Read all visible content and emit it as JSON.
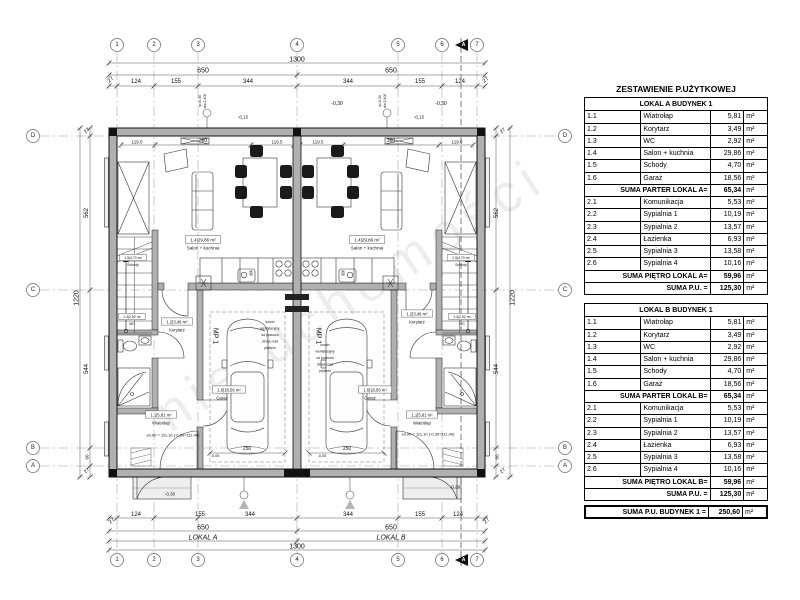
{
  "title": "ZESTAWIENIE P.UŻYTKOWEJ",
  "unit": "m²",
  "watermark": "nieruchomości",
  "tables": [
    {
      "header": "LOKAL A BUDYNEK 1",
      "rows": [
        {
          "no": "1.1",
          "name": "Wiatrołap",
          "value": "5,81"
        },
        {
          "no": "1.2",
          "name": "Korytarz",
          "value": "3,49"
        },
        {
          "no": "1.3",
          "name": "WC",
          "value": "2,92"
        },
        {
          "no": "1.4",
          "name": "Salon + kuchnia",
          "value": "29,86"
        },
        {
          "no": "1.5",
          "name": "Schody",
          "value": "4,70"
        },
        {
          "no": "1.6",
          "name": "Garaż",
          "value": "18,56"
        },
        {
          "sum": "SUMA PARTER LOKAL A=",
          "value": "65,34"
        },
        {
          "no": "2.1",
          "name": "Komunikacja",
          "value": "5,53"
        },
        {
          "no": "2.2",
          "name": "Sypialnia 1",
          "value": "10,19"
        },
        {
          "no": "2.3",
          "name": "Sypialnia 2",
          "value": "13,57"
        },
        {
          "no": "2.4",
          "name": "Łazienka",
          "value": "6,93"
        },
        {
          "no": "2.5",
          "name": "Sypialnia 3",
          "value": "13,58"
        },
        {
          "no": "2.6",
          "name": "Sypialnia 4",
          "value": "10,16"
        },
        {
          "sum": "SUMA PIĘTRO LOKAL A=",
          "value": "59,96"
        },
        {
          "sum": "SUMA P.U. =",
          "value": "125,30"
        }
      ]
    },
    {
      "header": "LOKAL B BUDYNEK 1",
      "rows": [
        {
          "no": "1.1",
          "name": "Wiatrołap",
          "value": "5,81"
        },
        {
          "no": "1.2",
          "name": "Korytarz",
          "value": "3,49"
        },
        {
          "no": "1.3",
          "name": "WC",
          "value": "2,92"
        },
        {
          "no": "1.4",
          "name": "Salon + kuchnia",
          "value": "29,86"
        },
        {
          "no": "1.5",
          "name": "Schody",
          "value": "4,70"
        },
        {
          "no": "1.6",
          "name": "Garaż",
          "value": "18,56"
        },
        {
          "sum": "SUMA PARTER LOKAL B=",
          "value": "65,34"
        },
        {
          "no": "2.1",
          "name": "Komunikacja",
          "value": "5,53"
        },
        {
          "no": "2.2",
          "name": "Sypialnia 1",
          "value": "10,19"
        },
        {
          "no": "2.3",
          "name": "Sypialnia 2",
          "value": "13,57"
        },
        {
          "no": "2.4",
          "name": "Łazienka",
          "value": "6,93"
        },
        {
          "no": "2.5",
          "name": "Sypialnia 3",
          "value": "13,58"
        },
        {
          "no": "2.6",
          "name": "Sypialnia 4",
          "value": "10,16"
        },
        {
          "sum": "SUMA PIĘTRO LOKAL B=",
          "value": "59,96"
        },
        {
          "sum": "SUMA P.U. =",
          "value": "125,30"
        }
      ]
    }
  ],
  "grand_total": {
    "label": "SUMA P.U. BUDYNEK 1 =",
    "value": "250,60"
  },
  "plan": {
    "bubbles": [
      {
        "l": "1",
        "x": 117,
        "y": 45
      },
      {
        "l": "2",
        "x": 154,
        "y": 45
      },
      {
        "l": "3",
        "x": 198,
        "y": 45
      },
      {
        "l": "4",
        "x": 297,
        "y": 45
      },
      {
        "l": "5",
        "x": 398,
        "y": 45
      },
      {
        "l": "6",
        "x": 442,
        "y": 45
      },
      {
        "l": "7",
        "x": 477,
        "y": 45
      },
      {
        "l": "1",
        "x": 117,
        "y": 560
      },
      {
        "l": "2",
        "x": 154,
        "y": 560
      },
      {
        "l": "3",
        "x": 198,
        "y": 560
      },
      {
        "l": "4",
        "x": 297,
        "y": 560
      },
      {
        "l": "5",
        "x": 398,
        "y": 560
      },
      {
        "l": "6",
        "x": 442,
        "y": 560
      },
      {
        "l": "7",
        "x": 477,
        "y": 560
      },
      {
        "l": "D",
        "x": 33,
        "y": 136
      },
      {
        "l": "C",
        "x": 33,
        "y": 290
      },
      {
        "l": "B",
        "x": 33,
        "y": 448
      },
      {
        "l": "A",
        "x": 33,
        "y": 466
      },
      {
        "l": "D",
        "x": 565,
        "y": 136
      },
      {
        "l": "C",
        "x": 565,
        "y": 290
      },
      {
        "l": "B",
        "x": 565,
        "y": 448
      },
      {
        "l": "A",
        "x": 565,
        "y": 466
      }
    ],
    "section_markers": [
      {
        "l": "A",
        "x": 461,
        "y": 45
      },
      {
        "l": "A",
        "x": 461,
        "y": 560
      }
    ],
    "texts": [
      {
        "t": "1300",
        "x": 297,
        "y": 60,
        "s": 7
      },
      {
        "t": "650",
        "x": 203,
        "y": 71,
        "s": 7
      },
      {
        "t": "650",
        "x": 391,
        "y": 71,
        "s": 7
      },
      {
        "t": "27",
        "x": 111,
        "y": 80,
        "s": 5.5,
        "r": -45
      },
      {
        "t": "124",
        "x": 136,
        "y": 82,
        "s": 6
      },
      {
        "t": "155",
        "x": 176,
        "y": 82,
        "s": 6
      },
      {
        "t": "344",
        "x": 248,
        "y": 82,
        "s": 6
      },
      {
        "t": "344",
        "x": 348,
        "y": 82,
        "s": 6
      },
      {
        "t": "155",
        "x": 420,
        "y": 82,
        "s": 6
      },
      {
        "t": "124",
        "x": 460,
        "y": 82,
        "s": 6
      },
      {
        "t": "27",
        "x": 486,
        "y": 80,
        "s": 5.5,
        "r": -45
      },
      {
        "t": "-0,30",
        "x": 337,
        "y": 104,
        "s": 5
      },
      {
        "t": "-0,30",
        "x": 441,
        "y": 104,
        "s": 5
      },
      {
        "t": "-0,15",
        "x": 243,
        "y": 117,
        "s": 4.5
      },
      {
        "t": "-0,15",
        "x": 419,
        "y": 117,
        "s": 4.5
      },
      {
        "t": "rp=0,00",
        "x": 200,
        "y": 101,
        "s": 3.5,
        "r": -90
      },
      {
        "t": "dn=2,400",
        "x": 205,
        "y": 101,
        "s": 3.5,
        "r": -90
      },
      {
        "t": "rp=0,00",
        "x": 380,
        "y": 101,
        "s": 3.5,
        "r": -90
      },
      {
        "t": "dn=2,400",
        "x": 385,
        "y": 101,
        "s": 3.5,
        "r": -90
      },
      {
        "t": "119.5",
        "x": 137,
        "y": 142,
        "s": 4.5
      },
      {
        "t": "360",
        "x": 203,
        "y": 141,
        "s": 5
      },
      {
        "t": "119.5",
        "x": 277,
        "y": 142,
        "s": 4.5
      },
      {
        "t": "119.5",
        "x": 318,
        "y": 142,
        "s": 4.5
      },
      {
        "t": "360",
        "x": 391,
        "y": 141,
        "s": 5
      },
      {
        "t": "119.5",
        "x": 457,
        "y": 142,
        "s": 4.5
      },
      {
        "t": "1.4|29,86 m²",
        "x": 203,
        "y": 240,
        "s": 4.5,
        "box": 1
      },
      {
        "t": "Salon + kuchnia",
        "x": 203,
        "y": 248,
        "s": 4.5
      },
      {
        "t": "1.4|29,86 m²",
        "x": 367,
        "y": 240,
        "s": 4.5,
        "box": 1
      },
      {
        "t": "Salon + kuchnia",
        "x": 367,
        "y": 248,
        "s": 4.5
      },
      {
        "t": "1.5|4,70 m²",
        "x": 133,
        "y": 258,
        "s": 3.5,
        "box": 1
      },
      {
        "t": "Schody",
        "x": 133,
        "y": 265,
        "s": 3.5
      },
      {
        "t": "1.5|4,70 m²",
        "x": 461,
        "y": 258,
        "s": 3.5,
        "box": 1
      },
      {
        "t": "Schody",
        "x": 461,
        "y": 265,
        "s": 3.5
      },
      {
        "t": "1.3|2,92 m²",
        "x": 132,
        "y": 317,
        "s": 3.5,
        "box": 1
      },
      {
        "t": "WC",
        "x": 132,
        "y": 324,
        "s": 3.5
      },
      {
        "t": "1.3|2,92 m²",
        "x": 462,
        "y": 317,
        "s": 3.5,
        "box": 1
      },
      {
        "t": "WC",
        "x": 462,
        "y": 324,
        "s": 3.5
      },
      {
        "t": "1.2|3,49 m²",
        "x": 177,
        "y": 322,
        "s": 4.2,
        "box": 1
      },
      {
        "t": "Korytarz",
        "x": 177,
        "y": 330,
        "s": 4.2
      },
      {
        "t": "1.2|3,49 m²",
        "x": 417,
        "y": 314,
        "s": 4.2,
        "box": 1
      },
      {
        "t": "Korytarz",
        "x": 417,
        "y": 322,
        "s": 4.2
      },
      {
        "t": "1.1|5,81 m²",
        "x": 161,
        "y": 415,
        "s": 4.2,
        "box": 1
      },
      {
        "t": "Wiatrołap",
        "x": 161,
        "y": 423,
        "s": 4.2
      },
      {
        "t": "1.1|5,81 m²",
        "x": 422,
        "y": 415,
        "s": 4.2,
        "box": 1
      },
      {
        "t": "Wiatrołap",
        "x": 422,
        "y": 423,
        "s": 4.2
      },
      {
        "t": "1.6|18,56 m²",
        "x": 229,
        "y": 390,
        "s": 4.2,
        "box": 1
      },
      {
        "t": "Garaż",
        "x": 222,
        "y": 398,
        "s": 4.2
      },
      {
        "t": "1.6|18,56 m²",
        "x": 375,
        "y": 390,
        "s": 4.2,
        "box": 1
      },
      {
        "t": "Garaż",
        "x": 370,
        "y": 398,
        "s": 4.2
      },
      {
        "t": "MP 1",
        "x": 215,
        "y": 336,
        "s": 7,
        "r": 90
      },
      {
        "t": "MP 1",
        "x": 318,
        "y": 336,
        "s": 7,
        "r": 90
      },
      {
        "t": "komin",
        "x": 270,
        "y": 322,
        "s": 3.4
      },
      {
        "t": "wentylacyjny",
        "x": 270,
        "y": 328.5,
        "s": 3.4
      },
      {
        "t": "od poziomu",
        "x": 270,
        "y": 335,
        "s": 3.4
      },
      {
        "t": "stropu nad",
        "x": 270,
        "y": 341.5,
        "s": 3.4
      },
      {
        "t": "piętrem",
        "x": 270,
        "y": 348,
        "s": 3.4
      },
      {
        "t": "komin",
        "x": 325,
        "y": 345,
        "s": 3.4
      },
      {
        "t": "wentylacyjny",
        "x": 325,
        "y": 351.5,
        "s": 3.4
      },
      {
        "t": "od poziomu",
        "x": 325,
        "y": 358,
        "s": 3.4
      },
      {
        "t": "stropu nad",
        "x": 325,
        "y": 364.5,
        "s": 3.4
      },
      {
        "t": "piętrem",
        "x": 325,
        "y": 371,
        "s": 3.4
      },
      {
        "t": "±0,00 = 111,10 (-0,30=111,40)",
        "x": 173,
        "y": 435,
        "s": 4
      },
      {
        "t": "±0,00 = 111,10 (-0,30=111,40)",
        "x": 428,
        "y": 434,
        "s": 4
      },
      {
        "t": "250",
        "x": 247,
        "y": 449,
        "s": 5
      },
      {
        "t": "250",
        "x": 347,
        "y": 449,
        "s": 5
      },
      {
        "t": "-0,05",
        "x": 215,
        "y": 456,
        "s": 3.8
      },
      {
        "t": "-0,05",
        "x": 322,
        "y": 456,
        "s": 3.8
      },
      {
        "t": "-0,30",
        "x": 170,
        "y": 494,
        "s": 4.5
      },
      {
        "t": "-0,30",
        "x": 455,
        "y": 487,
        "s": 4.5
      },
      {
        "t": "124",
        "x": 136,
        "y": 515,
        "s": 6
      },
      {
        "t": "155",
        "x": 200,
        "y": 515,
        "s": 6
      },
      {
        "t": "344",
        "x": 250,
        "y": 515,
        "s": 6
      },
      {
        "t": "344",
        "x": 348,
        "y": 515,
        "s": 6
      },
      {
        "t": "155",
        "x": 420,
        "y": 515,
        "s": 6
      },
      {
        "t": "124",
        "x": 458,
        "y": 515,
        "s": 6
      },
      {
        "t": "27",
        "x": 112,
        "y": 521,
        "s": 5.5,
        "r": -45
      },
      {
        "t": "27",
        "x": 487,
        "y": 521,
        "s": 5.5,
        "r": -45
      },
      {
        "t": "650",
        "x": 203,
        "y": 528,
        "s": 7
      },
      {
        "t": "650",
        "x": 391,
        "y": 528,
        "s": 7
      },
      {
        "t": "LOKAL A",
        "x": 203,
        "y": 538,
        "s": 7,
        "i": 1
      },
      {
        "t": "LOKAL B",
        "x": 391,
        "y": 538,
        "s": 7,
        "i": 1
      },
      {
        "t": "1300",
        "x": 297,
        "y": 547,
        "s": 7
      },
      {
        "t": "27",
        "x": 87,
        "y": 131,
        "s": 5,
        "r": -45
      },
      {
        "t": "562",
        "x": 87,
        "y": 213,
        "s": 6,
        "r": -90
      },
      {
        "t": "1220",
        "x": 77,
        "y": 298,
        "s": 7,
        "r": -90
      },
      {
        "t": "544",
        "x": 87,
        "y": 369,
        "s": 6,
        "r": -90
      },
      {
        "t": "60",
        "x": 87,
        "y": 457,
        "s": 4.5,
        "r": -90
      },
      {
        "t": "27",
        "x": 87,
        "y": 471,
        "s": 5,
        "r": -45
      },
      {
        "t": "27",
        "x": 503,
        "y": 131,
        "s": 5,
        "r": -45
      },
      {
        "t": "562",
        "x": 497,
        "y": 213,
        "s": 6,
        "r": -90
      },
      {
        "t": "1220",
        "x": 513,
        "y": 298,
        "s": 7,
        "r": -90
      },
      {
        "t": "544",
        "x": 497,
        "y": 369,
        "s": 6,
        "r": -90
      },
      {
        "t": "60",
        "x": 497,
        "y": 457,
        "s": 4.5,
        "r": -90
      },
      {
        "t": "27",
        "x": 503,
        "y": 471,
        "s": 5,
        "r": -45
      }
    ]
  }
}
